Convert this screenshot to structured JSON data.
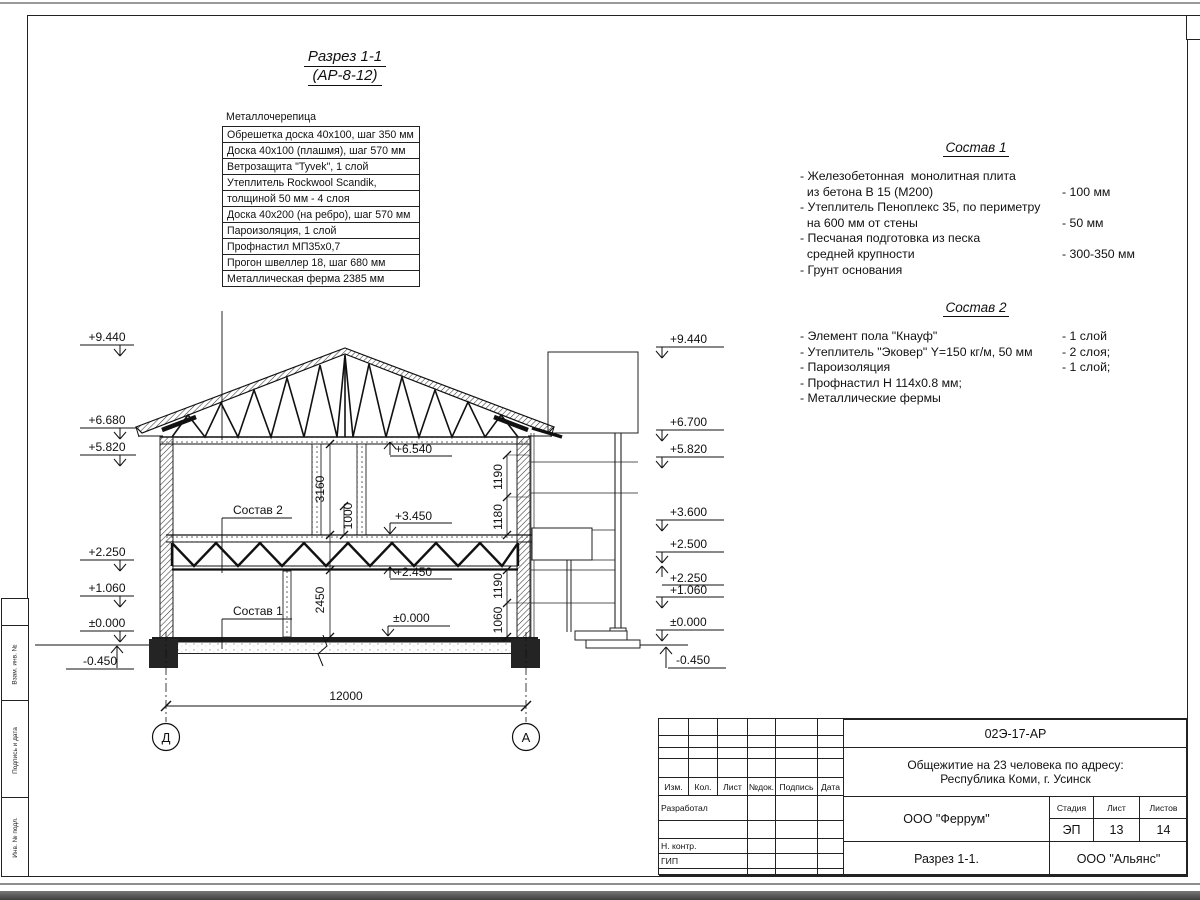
{
  "sheet_title": {
    "line1": "Разрез 1-1",
    "line2": "(АР-8-12)"
  },
  "materials": {
    "header": "Металлочерепица",
    "rows": [
      "Обрешетка доска 40х100, шаг 350 мм",
      "Доска 40х100 (плашмя), шаг 570 мм",
      "Ветрозащита \"Tyvek\", 1 слой",
      "Утеплитель Rockwool Scandik,",
      "толщиной 50 мм - 4 слоя",
      "Доска 40х200 (на ребро), шаг 570 мм",
      "Пароизоляция, 1 слой",
      "Профнастил МП35х0,7",
      "Прогон швеллер 18, шаг 680 мм",
      "Металлическая ферма 2385 мм"
    ]
  },
  "sostav1": {
    "title": "Состав 1",
    "items": [
      {
        "text": "- Железобетонная  монолитная плита",
        "value": ""
      },
      {
        "text": "  из бетона В 15 (М200)",
        "value": "- 100 мм"
      },
      {
        "text": "- Утеплитель Пеноплекс 35, по периметру",
        "value": ""
      },
      {
        "text": "  на 600 мм от стены",
        "value": "- 50 мм"
      },
      {
        "text": "- Песчаная подготовка из песка",
        "value": ""
      },
      {
        "text": "  средней крупности",
        "value": "- 300-350 мм"
      },
      {
        "text": "- Грунт основания",
        "value": ""
      }
    ]
  },
  "sostav2": {
    "title": "Состав 2",
    "items": [
      {
        "text": "- Элемент пола \"Кнауф\"",
        "value": "- 1 слой"
      },
      {
        "text": "- Утеплитель \"Эковер\" Y=150 кг/м, 50 мм",
        "value": "- 2 слоя;"
      },
      {
        "text": "- Пароизоляция",
        "value": "- 1 слой;"
      },
      {
        "text": "- Профнастил Н 114х0.8 мм;",
        "value": ""
      },
      {
        "text": "- Металлические фермы",
        "value": ""
      }
    ]
  },
  "elev": {
    "left": [
      "+9.440",
      "+6.680",
      "+5.820",
      "+2.250",
      "+1.060",
      "±0.000",
      "-0.450"
    ],
    "right": [
      "+9.440",
      "+6.700",
      "+5.820",
      "+3.600",
      "+2.500",
      "+2.250",
      "+1.060",
      "±0.000",
      "-0.450"
    ],
    "interior": [
      "+6.540",
      "+3.450",
      "+2.450",
      "±0.000"
    ]
  },
  "dims": {
    "span": "12000",
    "floor2_height": "3160",
    "dim_1000": "1000",
    "win_up_top": "1190",
    "win_up_bot": "1180",
    "floor1_height": "2450",
    "win_low_top": "1190",
    "win_low_bot": "1060"
  },
  "axes": {
    "left": "Д",
    "right": "А"
  },
  "callouts": {
    "sostav2": "Состав 2",
    "sostav1": "Состав 1"
  },
  "titleblock": {
    "doc_number": "02Э-17-АР",
    "project_line1": "Общежитие на 23 человека по адресу:",
    "project_line2": "Республика Коми, г. Усинск",
    "org": "ООО \"Феррум\"",
    "stage_label": "Стадия",
    "sheet_label": "Лист",
    "sheets_label": "Листов",
    "stage": "ЭП",
    "sheet": "13",
    "sheets": "14",
    "drawing_name": "Разрез 1-1.",
    "contractor": "ООО \"Альянс\"",
    "cols": [
      "Изм.",
      "Кол.",
      "Лист",
      "№док.",
      "Подпись",
      "Дата"
    ],
    "row_developed": "Разработал",
    "row_ncontr": "Н. контр.",
    "row_gip": "ГИП"
  },
  "sidebar": {
    "labels": [
      "Взам. инв. №",
      "Подпись и дата",
      "Инв. № подл."
    ]
  }
}
